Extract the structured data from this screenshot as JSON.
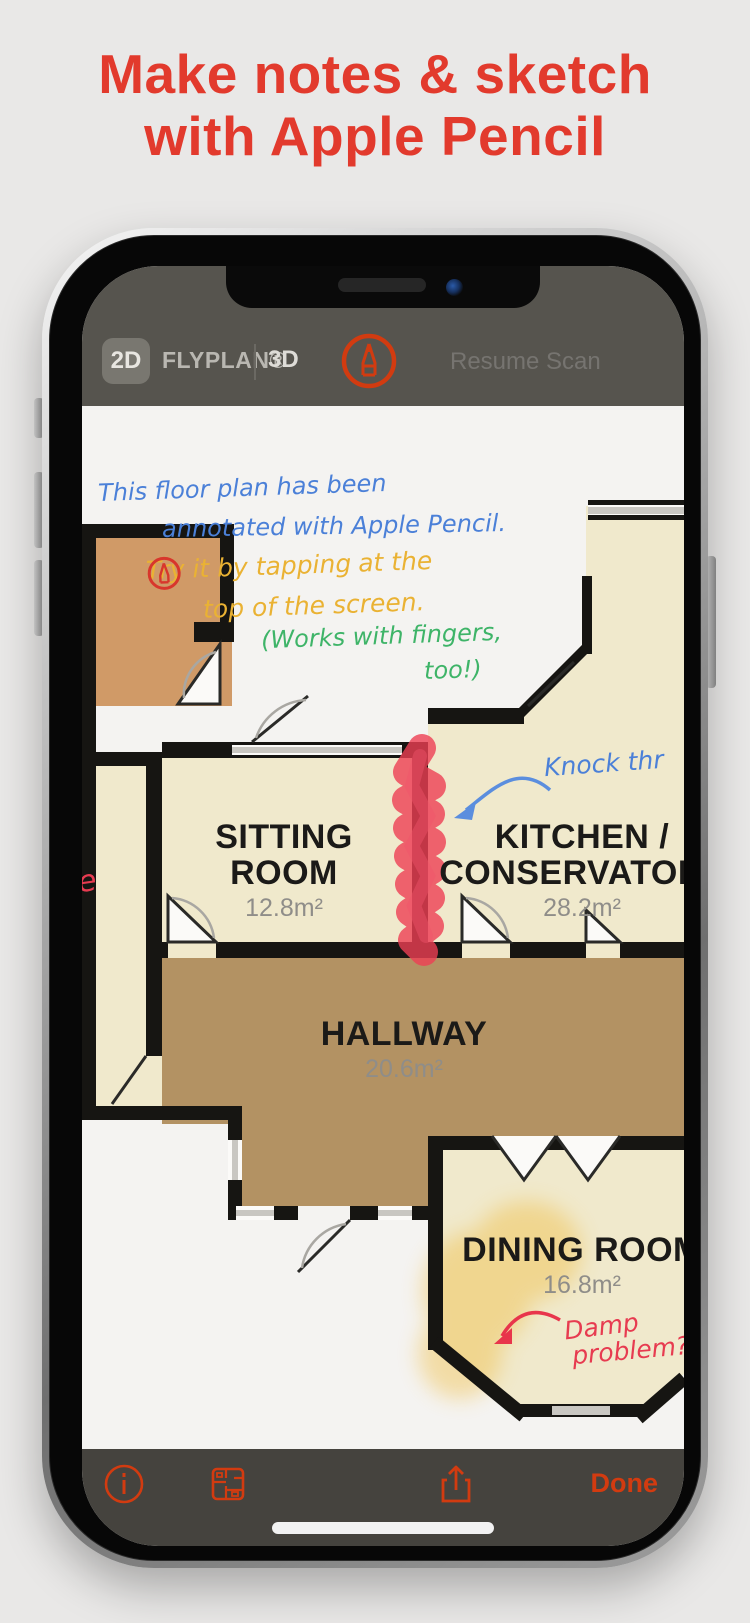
{
  "headline": {
    "line1": "Make notes & sketch",
    "line2": "with Apple Pencil"
  },
  "top_bar": {
    "mode_2d": "2D",
    "brand": "FLYPLAN®",
    "mode_3d": "3D",
    "resume_scan": "Resume Scan"
  },
  "annotations": {
    "blue_line1": "This floor plan has been",
    "blue_line2": "annotated with Apple Pencil.",
    "orange_before_icon": "Try it by tapping",
    "orange_after_icon": "at the",
    "orange_line2": "top of the screen.",
    "green_line1": "(Works with fingers,",
    "green_line2": "too!)",
    "knock_through": "Knock thr",
    "damp_line1": "Damp",
    "damp_line2": "problem?",
    "left_edge_fragment": "e"
  },
  "rooms": {
    "sitting": {
      "name_line1": "SITTING",
      "name_line2": "ROOM",
      "area": "12.8m²"
    },
    "kitchen": {
      "name_line1": "KITCHEN /",
      "name_line2": "CONSERVATORY",
      "area": "28.2m²"
    },
    "hallway": {
      "name": "HALLWAY",
      "area": "20.6m²"
    },
    "dining": {
      "name": "DINING ROOM",
      "area": "16.8m²"
    }
  },
  "toolbar": {
    "done_label": "Done"
  },
  "colors": {
    "headline_red": "#e23a2d",
    "accent_red": "#d23b10",
    "ink_blue": "#4b80d8",
    "ink_orange": "#eab233",
    "ink_green": "#3eb468",
    "ink_red": "#e73b50",
    "floor_beige": "#f0e9cc",
    "floor_tan": "#d09a67",
    "floor_brown": "#b39263",
    "topbar_gray": "#56544e"
  }
}
